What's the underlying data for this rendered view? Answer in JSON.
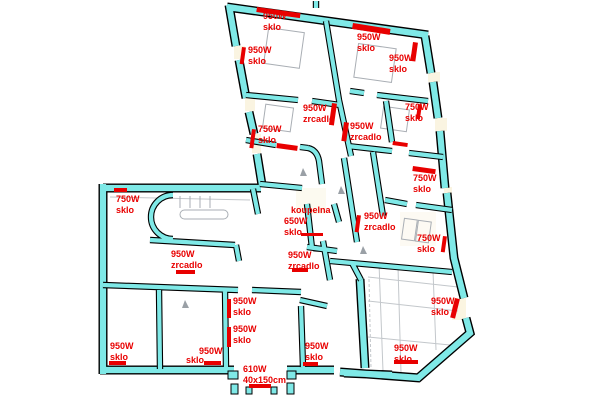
{
  "title": "floor-plan-heater-annotations",
  "palette": {
    "wall_fill": "#7FE9E7",
    "wall_outline": "#000000",
    "marker_red": "#E80000",
    "fixture_gray": "#A9AEB4",
    "dim_gray": "#C3C7CB",
    "window_cream": "#FAF3DC",
    "background": "#FFFFFF"
  },
  "legend_terms": {
    "sklo": "sklo",
    "zrcadlo": "zrcadlo",
    "koupelna": "koupelna"
  },
  "labels": [
    {
      "x": 263,
      "y": 11,
      "rot": 0,
      "lines": [
        "950W",
        "sklo"
      ]
    },
    {
      "x": 248,
      "y": 45,
      "rot": 0,
      "lines": [
        "950W",
        "sklo"
      ]
    },
    {
      "x": 357,
      "y": 32,
      "rot": 0,
      "lines": [
        "950W",
        "sklo"
      ]
    },
    {
      "x": 389,
      "y": 53,
      "rot": 0,
      "lines": [
        "950W",
        "sklo"
      ]
    },
    {
      "x": 303,
      "y": 103,
      "rot": 0,
      "lines": [
        "950W",
        "zrcadlo"
      ]
    },
    {
      "x": 258,
      "y": 124,
      "rot": 0,
      "lines": [
        "750W",
        "sklo"
      ]
    },
    {
      "x": 350,
      "y": 121,
      "rot": 0,
      "lines": [
        "950W",
        "zrcadlo"
      ]
    },
    {
      "x": 405,
      "y": 102,
      "rot": 0,
      "lines": [
        "750W",
        "sklo"
      ]
    },
    {
      "x": 413,
      "y": 173,
      "rot": 0,
      "lines": [
        "750W",
        "sklo"
      ]
    },
    {
      "x": 417,
      "y": 233,
      "rot": 0,
      "lines": [
        "750W",
        "sklo"
      ]
    },
    {
      "x": 364,
      "y": 211,
      "rot": 0,
      "lines": [
        "950W",
        "zrcadlo"
      ]
    },
    {
      "x": 291,
      "y": 205,
      "rot": 0,
      "lines": [
        "koupelna"
      ]
    },
    {
      "x": 284,
      "y": 216,
      "rot": 0,
      "lines": [
        "650W",
        "sklo"
      ]
    },
    {
      "x": 288,
      "y": 250,
      "rot": 0,
      "lines": [
        "950W",
        "zrcadlo"
      ]
    },
    {
      "x": 116,
      "y": 194,
      "rot": 0,
      "lines": [
        "750W",
        "sklo"
      ]
    },
    {
      "x": 171,
      "y": 249,
      "rot": 0,
      "lines": [
        "950W",
        "zrcadlo"
      ]
    },
    {
      "x": 233,
      "y": 296,
      "rot": 0,
      "lines": [
        "950W",
        "sklo"
      ]
    },
    {
      "x": 233,
      "y": 324,
      "rot": 0,
      "lines": [
        "950W",
        "sklo"
      ]
    },
    {
      "x": 110,
      "y": 341,
      "rot": 0,
      "lines": [
        "950W",
        "sklo"
      ]
    },
    {
      "x": 199,
      "y": 346,
      "rot": 0,
      "lines": [
        "950W"
      ]
    },
    {
      "x": 186,
      "y": 355,
      "rot": 0,
      "lines": [
        "sklo"
      ]
    },
    {
      "x": 305,
      "y": 341,
      "rot": 0,
      "lines": [
        "950W",
        "sklo"
      ]
    },
    {
      "x": 394,
      "y": 343,
      "rot": 0,
      "lines": [
        "950W",
        "sklo"
      ]
    },
    {
      "x": 431,
      "y": 296,
      "rot": 0,
      "lines": [
        "950W",
        "sklo"
      ]
    },
    {
      "x": 243,
      "y": 364,
      "rot": 0,
      "lines": [
        "610W",
        "40x150cm"
      ]
    }
  ],
  "markers": [
    {
      "x": 257,
      "y": 7,
      "w": 44,
      "h": 5,
      "rot": 8
    },
    {
      "x": 242,
      "y": 47,
      "w": 4,
      "h": 17,
      "rot": 8
    },
    {
      "x": 353,
      "y": 23,
      "w": 38,
      "h": 6,
      "rot": 9
    },
    {
      "x": 413,
      "y": 42,
      "w": 5,
      "h": 19,
      "rot": 8
    },
    {
      "x": 332,
      "y": 103,
      "w": 5,
      "h": 22,
      "rot": 8
    },
    {
      "x": 252,
      "y": 129,
      "w": 4,
      "h": 19,
      "rot": 8
    },
    {
      "x": 344,
      "y": 122,
      "w": 5,
      "h": 19,
      "rot": 8
    },
    {
      "x": 418,
      "y": 104,
      "w": 4,
      "h": 15,
      "rot": 8
    },
    {
      "x": 413,
      "y": 166,
      "w": 23,
      "h": 5,
      "rot": 8
    },
    {
      "x": 443,
      "y": 236,
      "w": 4,
      "h": 16,
      "rot": 8
    },
    {
      "x": 357,
      "y": 215,
      "w": 4,
      "h": 17,
      "rot": 8
    },
    {
      "x": 301,
      "y": 233,
      "w": 22,
      "h": 3,
      "rot": 0
    },
    {
      "x": 292,
      "y": 268,
      "w": 16,
      "h": 4,
      "rot": 0
    },
    {
      "x": 114,
      "y": 188,
      "w": 13,
      "h": 4,
      "rot": 0
    },
    {
      "x": 176,
      "y": 270,
      "w": 19,
      "h": 4,
      "rot": 0
    },
    {
      "x": 227,
      "y": 299,
      "w": 4,
      "h": 19,
      "rot": 0
    },
    {
      "x": 227,
      "y": 327,
      "w": 4,
      "h": 20,
      "rot": 0
    },
    {
      "x": 109,
      "y": 361,
      "w": 17,
      "h": 4,
      "rot": 0
    },
    {
      "x": 204,
      "y": 361,
      "w": 17,
      "h": 4,
      "rot": 0
    },
    {
      "x": 303,
      "y": 362,
      "w": 15,
      "h": 4,
      "rot": 0
    },
    {
      "x": 394,
      "y": 360,
      "w": 24,
      "h": 4,
      "rot": 0
    },
    {
      "x": 455,
      "y": 298,
      "w": 5,
      "h": 20,
      "rot": 14
    },
    {
      "x": 249,
      "y": 384,
      "w": 22,
      "h": 4,
      "rot": 0
    },
    {
      "x": 277,
      "y": 143,
      "w": 21,
      "h": 5,
      "rot": 8
    },
    {
      "x": 393,
      "y": 141,
      "w": 15,
      "h": 4,
      "rot": 8
    }
  ]
}
